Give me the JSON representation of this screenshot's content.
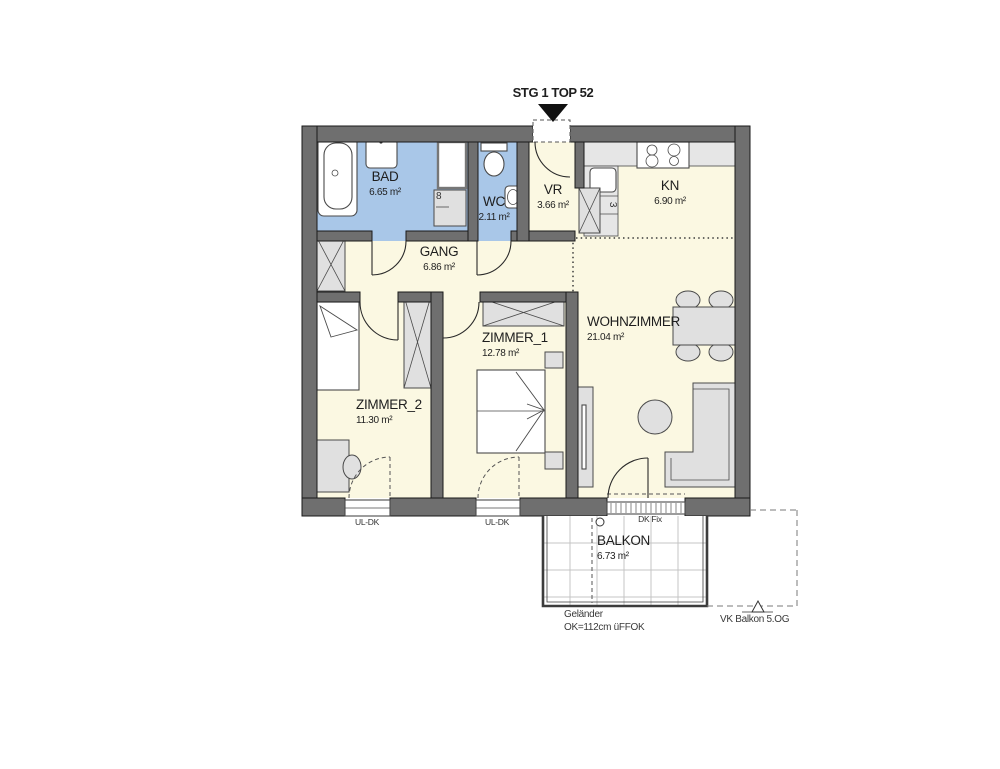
{
  "title": "STG 1 TOP 52",
  "colors": {
    "wall": "#6f6f6f",
    "wet": "#a9c7e8",
    "room": "#fbf8e2",
    "furn": "#e0e0e0",
    "counter": "#e6e6e6",
    "grid": "#c4c4c4",
    "text": "#1e1e1e"
  },
  "rooms": {
    "bad": {
      "name": "BAD",
      "area": "6.65 m²"
    },
    "wc": {
      "name": "WC",
      "area": "2.11 m²"
    },
    "vr": {
      "name": "VR",
      "area": "3.66 m²"
    },
    "kn": {
      "name": "KN",
      "area": "6.90 m²"
    },
    "gang": {
      "name": "GANG",
      "area": "6.86 m²"
    },
    "zimmer1": {
      "name": "ZIMMER_1",
      "area": "12.78 m²"
    },
    "zimmer2": {
      "name": "ZIMMER_2",
      "area": "11.30 m²"
    },
    "wohnzimmer": {
      "name": "WOHNZIMMER",
      "area": "21.04 m²"
    },
    "balkon": {
      "name": "BALKON",
      "area": "6.73 m²"
    }
  },
  "annotations": {
    "window_zimmer2": "UL-DK",
    "window_zimmer1": "UL-DK",
    "balcony_fixed": "DK Fix",
    "railing_line1": "Geländer",
    "railing_line2": "OK=112cm üFFOK",
    "balcony_above": "VK Balkon 5.OG",
    "appliance_bad": "8",
    "appliance_kn": "3"
  }
}
